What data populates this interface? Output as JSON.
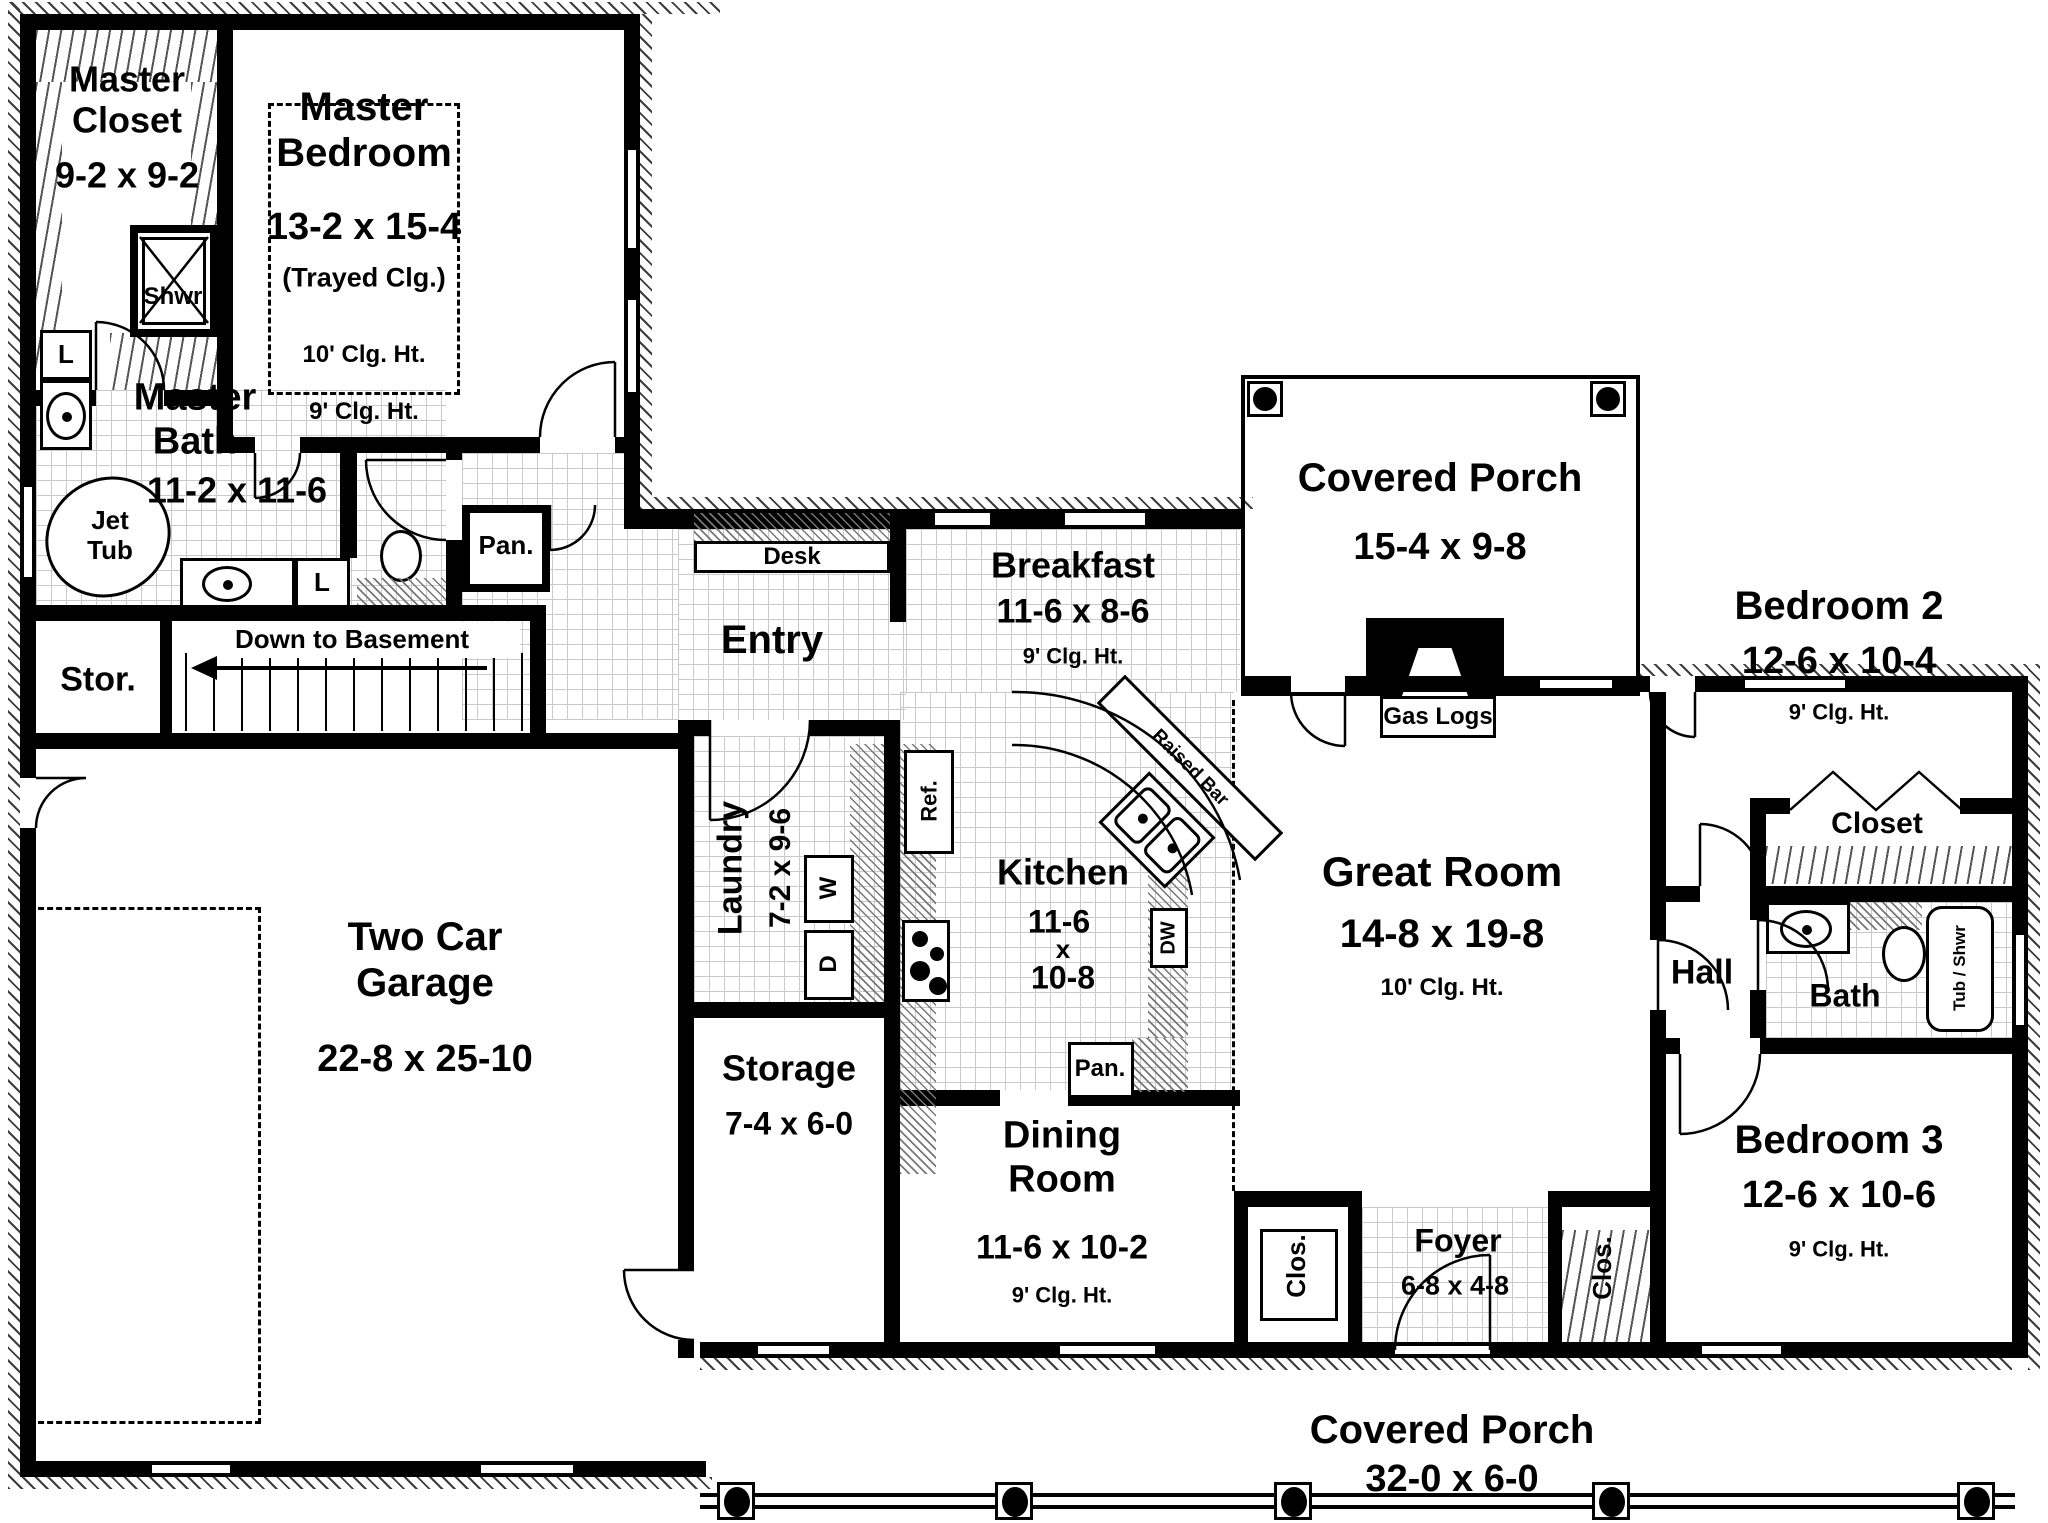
{
  "rooms": {
    "master_closet": {
      "name": "Master Closet",
      "dims": "9-2 x 9-2"
    },
    "master_bedroom": {
      "name": "Master Bedroom",
      "dims": "13-2 x 15-4",
      "note": "(Trayed Clg.)",
      "clg_upper": "10' Clg. Ht.",
      "clg_lower": "9' Clg. Ht."
    },
    "master_bath": {
      "name": "Master Bath",
      "dims": "11-2 x 11-6"
    },
    "stor": {
      "name": "Stor."
    },
    "entry": {
      "name": "Entry"
    },
    "breakfast": {
      "name": "Breakfast",
      "dims": "11-6 x 8-6",
      "clg": "9' Clg. Ht."
    },
    "porch_top": {
      "name": "Covered Porch",
      "dims": "15-4 x 9-8"
    },
    "bedroom2": {
      "name": "Bedroom 2",
      "dims": "12-6 x 10-4",
      "clg": "9' Clg. Ht."
    },
    "closet2": {
      "name": "Closet"
    },
    "great_room": {
      "name": "Great Room",
      "dims": "14-8 x 19-8",
      "clg": "10' Clg. Ht."
    },
    "hall": {
      "name": "Hall"
    },
    "bath": {
      "name": "Bath"
    },
    "kitchen": {
      "name": "Kitchen",
      "dim1": "11-6",
      "dim2": "x",
      "dim3": "10-8"
    },
    "laundry": {
      "name": "Laundry",
      "dims": "7-2 x 9-6"
    },
    "garage": {
      "name": "Two Car Garage",
      "dims": "22-8 x 25-10"
    },
    "storage": {
      "name": "Storage",
      "dims": "7-4 x 6-0"
    },
    "dining": {
      "name": "Dining Room",
      "dims": "11-6 x 10-2",
      "clg": "9' Clg. Ht."
    },
    "foyer": {
      "name": "Foyer",
      "dims": "6-8 x 4-8"
    },
    "bedroom3": {
      "name": "Bedroom 3",
      "dims": "12-6 x 10-6",
      "clg": "9' Clg. Ht."
    },
    "porch_bottom": {
      "name": "Covered Porch",
      "dims": "32-0 x 6-0"
    }
  },
  "labels": {
    "shower": "Shwr",
    "jet_tub": "Jet Tub",
    "linen": "L",
    "pantry": "Pan.",
    "desk": "Desk",
    "basement": "Down to Basement",
    "gas_logs": "Gas Logs",
    "fridge": "Ref.",
    "dishwasher": "DW",
    "raised_bar": "Raised Bar",
    "washer": "W",
    "dryer": "D",
    "closet_small": "Clos.",
    "tub_shower": "Tub / Shwr"
  }
}
